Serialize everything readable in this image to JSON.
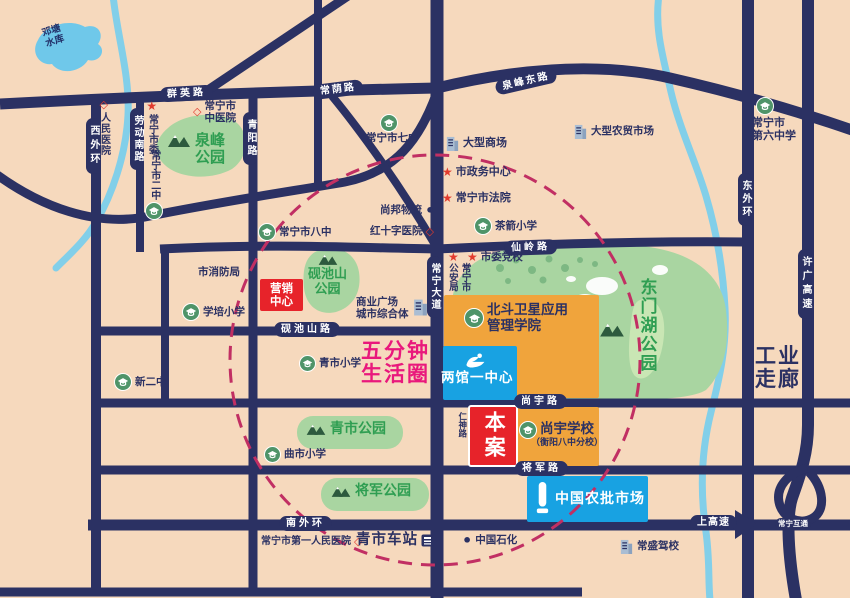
{
  "colors": {
    "bg": "#f6d9bd",
    "road": "#2b3163",
    "park": "#a9d5a1",
    "park_text": "#2f9e52",
    "water": "#7fcde9",
    "circle": "#c12f63",
    "pink": "#e9187c",
    "red": "#e7232a",
    "blue": "#18a2e2",
    "orange": "#f0a43c"
  },
  "water": {
    "reservoir": "邓塘\n水库"
  },
  "roads": {
    "qunying": "群英路",
    "changyin": "常荫路",
    "quanfengdong": "泉峰东路",
    "xianling": "仙岭路",
    "yanchishan": "砚池山路",
    "shangyu": "尚宇路",
    "jiangjun": "将军路",
    "nanwaihuan": "南外环",
    "shanggaosu": "上高速",
    "xiwaihuan": "西外环",
    "laodongnan": "劳动南路",
    "qingyang": "青阳路",
    "changningdadao": "常宁大道",
    "dongwaihuan": "东外环",
    "xuguang": "许广高速",
    "hutong": "常宁互通",
    "renshen": "仁神路"
  },
  "parks": {
    "quanfeng": "泉峰\n公园",
    "yanchishan": "砚池山\n公园",
    "dongmenhu": "东门湖公园",
    "qingshi": "青市公园",
    "jiangjun": "将军公园"
  },
  "blocks": {
    "marketing": "营销\n中心",
    "site": "本案",
    "liangguan": "两馆一中心",
    "nongpi": "中国农批市场",
    "beidou": "北斗卫星应用\n管理学院",
    "shangyu_school": "尚宇学校",
    "shangyu_school_sub": "（衡阳八中分校）"
  },
  "pois": {
    "renmin_hospital": "人民医院",
    "shiwei": "常宁市委",
    "erzhong": "常宁市二中",
    "zhongyiyuan": "常宁市\n中医院",
    "qizhong": "常宁市七中",
    "shangchang": "大型商场",
    "zhengwu": "市政务中心",
    "fayuan": "常宁市法院",
    "shangbang": "尚邦物流",
    "hongshizi": "红十字医院",
    "chajian": "茶箭小学",
    "bazhong": "常宁市八中",
    "xiaofang": "市消防局",
    "xuepei": "学培小学",
    "dangxiao": "市委党校",
    "gongan": "常宁市\n公安局",
    "zongheti": "商业广场\n城市综合体",
    "xinerzhong": "新二中",
    "qingshixx": "青市小学",
    "qushixx": "曲市小学",
    "liuzhong": "常宁市\n第六中学",
    "nongmao": "大型农贸市场",
    "renminyiyuan": "常宁市第一人民医院",
    "chezhan": "青市车站",
    "shihua": "中国石化",
    "jiaxiao": "常盛驾校"
  },
  "slogans": {
    "circle": "五分钟\n生活圈",
    "corridor": "工业\n走廊"
  },
  "icons": {
    "star": "★",
    "diamond": "◇",
    "dot": "•"
  }
}
